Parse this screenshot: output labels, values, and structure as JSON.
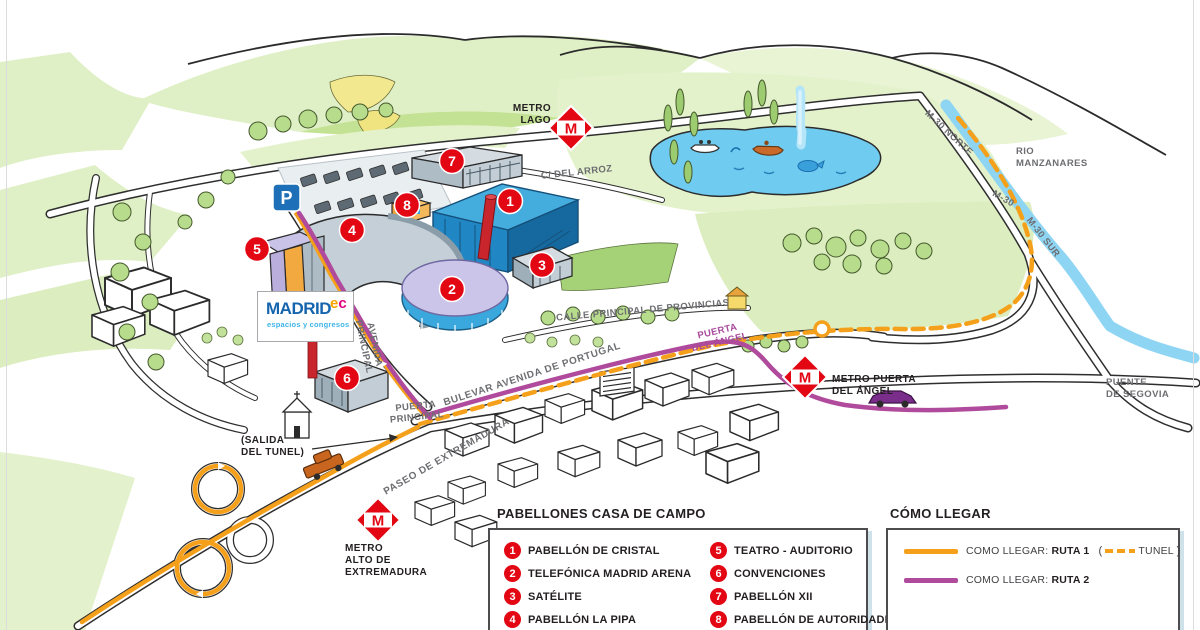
{
  "logo": {
    "brand": "MADRID",
    "sup_e": "e",
    "sup_c": "c",
    "tagline": "espacios y congresos"
  },
  "map": {
    "metro_m": "M",
    "parking": "P",
    "stations": {
      "lago": [
        "METRO",
        "LAGO"
      ],
      "alto": [
        "METRO",
        "ALTO DE",
        "EXTREMADURA"
      ],
      "puerta_angel": [
        "METRO PUERTA",
        "DEL ÁNGEL"
      ]
    },
    "streets": {
      "c_del_arroz": "C/ DEL ARROZ",
      "calle_principal_de_provincias": "CALLE PRINCIPAL DE PROVINCIAS",
      "bulevar_avenida_de_portugal": "BULEVAR AVENIDA DE PORTUGAL",
      "paseo_de_extremadura": "PASEO DE EXTREMADURA",
      "avenida_l1": "AVENIDA",
      "avenida_l2": "PRINCIPAL",
      "puerta_principal_l1": "PUERTA",
      "puerta_principal_l2": "PRINCIPAL",
      "m30_norte": "M-30 NORTE",
      "m30": "M-30",
      "m30_sur": "M-30 SUR"
    },
    "labels": {
      "rio_l1": "RIO",
      "rio_l2": "MANZANARES",
      "puente_l1": "PUENTE",
      "puente_l2": "DE SEGOVIA",
      "salida_l1": "(SALIDA",
      "salida_l2": "DEL TUNEL)",
      "puerta_angel_gate_l1": "PUERTA",
      "puerta_angel_gate_l2": "DEL ÁNGEL"
    }
  },
  "legend_pabellones": {
    "title": "PABELLONES CASA DE CAMPO",
    "items": [
      {
        "number": "1",
        "label": "PABELLÓN DE CRISTAL"
      },
      {
        "number": "2",
        "label": "TELEFÓNICA MADRID ARENA"
      },
      {
        "number": "3",
        "label": "SATÉLITE"
      },
      {
        "number": "4",
        "label": "PABELLÓN LA PIPA"
      },
      {
        "number": "5",
        "label": "TEATRO - AUDITORIO"
      },
      {
        "number": "6",
        "label": "CONVENCIONES"
      },
      {
        "number": "7",
        "label": "PABELLÓN XII"
      },
      {
        "number": "8",
        "label": "PABELLÓN DE AUTORIDADES"
      }
    ]
  },
  "legend_como_llegar": {
    "title": "CÓMO LLEGAR",
    "route1_prefix": "COMO LLEGAR:",
    "route1_bold": "RUTA 1",
    "tunel_open": "(",
    "tunel_label": "TUNEL",
    "tunel_close": ")",
    "route2_prefix": "COMO LLEGAR:",
    "route2_bold": "RUTA 2"
  },
  "colors": {
    "route1_orange": "#F5A01B",
    "route2_purple": "#B04A9C",
    "metro_red": "#E30613",
    "marker_red": "#E30613",
    "river_blue": "#8ED5F4",
    "lake_blue": "#6FCBEF",
    "hill_green": "#E0F0C6",
    "building_blue": "#2187C4"
  }
}
